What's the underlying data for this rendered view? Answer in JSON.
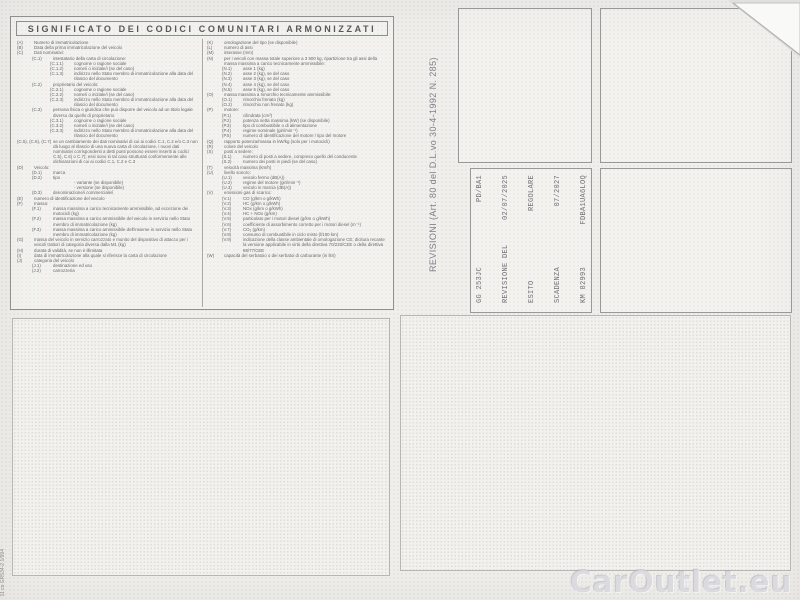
{
  "document": {
    "legend": {
      "title": "SIGNIFICATO DEI CODICI COMUNITARI ARMONIZZATI",
      "left_column": [
        {
          "indent": 0,
          "code": "(A)",
          "text": "Numero di immatricolazione"
        },
        {
          "indent": 0,
          "code": "(B)",
          "text": "Data della prima immatricolazione del veicolo"
        },
        {
          "indent": 0,
          "code": "(C)",
          "text": "Dati nominativi:"
        },
        {
          "indent": 1,
          "code": "(C.1)",
          "text": "intestatario della carta di circolazione:"
        },
        {
          "indent": 2,
          "code": "(C.1.1)",
          "text": "cognome o ragione sociale"
        },
        {
          "indent": 2,
          "code": "(C.1.2)",
          "text": "nome/i o iniziale/i (se del caso)"
        },
        {
          "indent": 2,
          "code": "(C.1.3)",
          "text": "indirizzo nello Stato membro di immatricolazione alla data del rilascio del documento"
        },
        {
          "indent": 1,
          "code": "(C.2)",
          "text": "proprietario del veicolo:"
        },
        {
          "indent": 2,
          "code": "(C.2.1)",
          "text": "cognome o ragione sociale"
        },
        {
          "indent": 2,
          "code": "(C.2.2)",
          "text": "nome/i o iniziale/i (se del caso)"
        },
        {
          "indent": 2,
          "code": "(C.2.3)",
          "text": "indirizzo nello Stato membro di immatricolazione alla data del rilascio del documento"
        },
        {
          "indent": 1,
          "code": "(C.3)",
          "text": "persona fisica o giuridica che può disporre del veicolo ad un titolo legale diverso da quello di proprietario"
        },
        {
          "indent": 2,
          "code": "(C.3.1)",
          "text": "cognome o ragione sociale"
        },
        {
          "indent": 2,
          "code": "(C.3.2)",
          "text": "nome/i o iniziale/i (se del caso)"
        },
        {
          "indent": 2,
          "code": "(C.3.3)",
          "text": "indirizzo nello Stato membro di immatricolazione alla data del rilascio del documento"
        },
        {
          "indent": 0,
          "code": "(C.5), (C.6), (C.7)",
          "text": "se un cambiamento dei dati nominativi di cui ai codici C.1, C.2 e/o C.3 non dà luogo al rilascio di una nuova carta di circolazione, i nuovi dati nominativi corrispondenti a detti punti possono essere inseriti ai codici C.5), C.6) o C.7); essi sono in tal caso strutturati conformemente alle dichiarazioni di cui ai codici C.1, C.2 e C.3"
        },
        {
          "indent": 0,
          "code": "(D)",
          "text": "Veicolo:"
        },
        {
          "indent": 1,
          "code": "(D.1)",
          "text": "marca"
        },
        {
          "indent": 1,
          "code": "(D.2)",
          "text": "tipo"
        },
        {
          "indent": 2,
          "code": "",
          "text": "- variante (se disponibile)"
        },
        {
          "indent": 2,
          "code": "",
          "text": "- versione (se disponibile)"
        },
        {
          "indent": 1,
          "code": "(D.3)",
          "text": "denominazione/i commerciale/i"
        },
        {
          "indent": 0,
          "code": "(E)",
          "text": "numero di identificazione del veicolo"
        },
        {
          "indent": 0,
          "code": "(F)",
          "text": "massa:"
        },
        {
          "indent": 1,
          "code": "(F.1)",
          "text": "massa massima a carico tecnicamente ammissibile, ad eccezione dei motocicli (kg)"
        },
        {
          "indent": 1,
          "code": "(F.2)",
          "text": "massa massima a carico ammissibile del veicolo in servizio nello Stato membro di immatricolazione (kg)"
        },
        {
          "indent": 1,
          "code": "(F.3)",
          "text": "massa massima a carico ammissibile dell'insieme in servizio nello Stato membro di immatricolazione (kg)"
        },
        {
          "indent": 0,
          "code": "(G)",
          "text": "massa del veicolo in servizio carrozzato e munito del dispositivo di attacco per i veicoli trattori di categoria diversa dalla M1 (kg)"
        },
        {
          "indent": 0,
          "code": "(H)",
          "text": "durata di validità, se non è illimitata"
        },
        {
          "indent": 0,
          "code": "(I)",
          "text": "data di immatricolazione alla quale si riferisce la carta di circolazione"
        },
        {
          "indent": 0,
          "code": "(J)",
          "text": "categoria del veicolo"
        },
        {
          "indent": 1,
          "code": "(J.1)",
          "text": "destinazione ed uso"
        },
        {
          "indent": 1,
          "code": "(J.2)",
          "text": "carrozzeria"
        }
      ],
      "right_column": [
        {
          "indent": 0,
          "code": "(K)",
          "text": "omologazione del tipo (se disponibile)"
        },
        {
          "indent": 0,
          "code": "(L)",
          "text": "numero di assi"
        },
        {
          "indent": 0,
          "code": "(M)",
          "text": "interasse (mm)"
        },
        {
          "indent": 0,
          "code": "(N)",
          "text": "per i veicoli con massa totale superiore a 3 500 kg, ripartizione tra gli assi della massa massima a carico tecnicamente ammissibile:"
        },
        {
          "indent": 1,
          "code": "(N.1)",
          "text": "asse 1 (kg)"
        },
        {
          "indent": 1,
          "code": "(N.2)",
          "text": "asse 2 (kg), se del caso"
        },
        {
          "indent": 1,
          "code": "(N.3)",
          "text": "asse 3 (kg), se del caso"
        },
        {
          "indent": 1,
          "code": "(N.4)",
          "text": "asse 4 (kg), se del caso"
        },
        {
          "indent": 1,
          "code": "(N.5)",
          "text": "asse 5 (kg), se del caso"
        },
        {
          "indent": 0,
          "code": "(O)",
          "text": "massa massima a rimorchio tecnicamente ammissibile:"
        },
        {
          "indent": 1,
          "code": "(O.1)",
          "text": "rimorchio frenato (kg)"
        },
        {
          "indent": 1,
          "code": "(O.2)",
          "text": "rimorchio non frenato (kg)"
        },
        {
          "indent": 0,
          "code": "(P)",
          "text": "motore:"
        },
        {
          "indent": 1,
          "code": "(P.1)",
          "text": "cilindrata (cm³)"
        },
        {
          "indent": 1,
          "code": "(P.2)",
          "text": "potenza netta massima (kW) (se disponibile)"
        },
        {
          "indent": 1,
          "code": "(P.3)",
          "text": "tipo di combustibile o di alimentazione"
        },
        {
          "indent": 1,
          "code": "(P.4)",
          "text": "regime nominale (giri/min⁻¹)"
        },
        {
          "indent": 1,
          "code": "(P.5)",
          "text": "numero di identificazione del motore / tipo del motore"
        },
        {
          "indent": 0,
          "code": "(Q)",
          "text": "rapporto potenza/massa in kW/kg (solo per i motocicli)"
        },
        {
          "indent": 0,
          "code": "(R)",
          "text": "colore del veicolo"
        },
        {
          "indent": 0,
          "code": "(S)",
          "text": "posti a sedere:"
        },
        {
          "indent": 1,
          "code": "(S.1)",
          "text": "numero di posti a sedere, compreso quello del conducente"
        },
        {
          "indent": 1,
          "code": "(S.2)",
          "text": "numero dei posti in piedi (se del caso)"
        },
        {
          "indent": 0,
          "code": "(T)",
          "text": "velocità massima (km/h)"
        },
        {
          "indent": 0,
          "code": "(U)",
          "text": "livello sonoro:"
        },
        {
          "indent": 1,
          "code": "(U.1)",
          "text": "veicolo fermo (dB(A))"
        },
        {
          "indent": 1,
          "code": "(U.2)",
          "text": "regime del motore (giri/min⁻¹)"
        },
        {
          "indent": 1,
          "code": "(U.3)",
          "text": "veicolo in marcia (dB(A))"
        },
        {
          "indent": 0,
          "code": "(V)",
          "text": "emissioni gas di scarico:"
        },
        {
          "indent": 1,
          "code": "(V.1)",
          "text": "CO (g/km o g/kWh)"
        },
        {
          "indent": 1,
          "code": "(V.2)",
          "text": "HC (g/km o g/kWh)"
        },
        {
          "indent": 1,
          "code": "(V.3)",
          "text": "NOx (g/km o g/kWh)"
        },
        {
          "indent": 1,
          "code": "(V.4)",
          "text": "HC + NOx (g/km)"
        },
        {
          "indent": 1,
          "code": "(V.5)",
          "text": "particolato per i motori diesel (g/km o g/kWh)"
        },
        {
          "indent": 1,
          "code": "(V.6)",
          "text": "coefficiente di assorbimento corretto per i motori diesel (m⁻¹)"
        },
        {
          "indent": 1,
          "code": "(V.7)",
          "text": "CO₂ (g/km)"
        },
        {
          "indent": 1,
          "code": "(V.8)",
          "text": "consumo di combustibile in ciclo misto (l/100 km)"
        },
        {
          "indent": 1,
          "code": "(V.9)",
          "text": "indicazione della classe ambientale di omologazione CE; dicitura recante la versione applicabile in virtù della direttiva 70/220/CEE o della direttiva 88/77/CEE"
        },
        {
          "indent": 0,
          "code": "(W)",
          "text": "capacità del serbatoio o dei serbatoi di carburante (in litri)"
        }
      ]
    },
    "revisioni": {
      "label": "REVISIONI (Art. 80 del D.L.vo 30-4-1992 N. 285)",
      "stamp_lines": [
        {
          "label": "GG 253JC",
          "value": "PD/BA1"
        },
        {
          "label": "REVISIONE DEL",
          "value": "02/07/2025"
        },
        {
          "label": "ESITO",
          "value": "REGOLARE"
        },
        {
          "label": "SCADENZA",
          "value": "07/2027"
        },
        {
          "label": "KM 82993",
          "value": "FDBA1UA6LOQ"
        }
      ]
    },
    "watermark": "CarOutlet.eu",
    "print_code": "11 co GR534-2 1/994",
    "colors": {
      "paper": "#f0efec",
      "ink": "#67676a",
      "stamp_ink": "#70707a",
      "watermark": "#c2c2cc"
    }
  }
}
